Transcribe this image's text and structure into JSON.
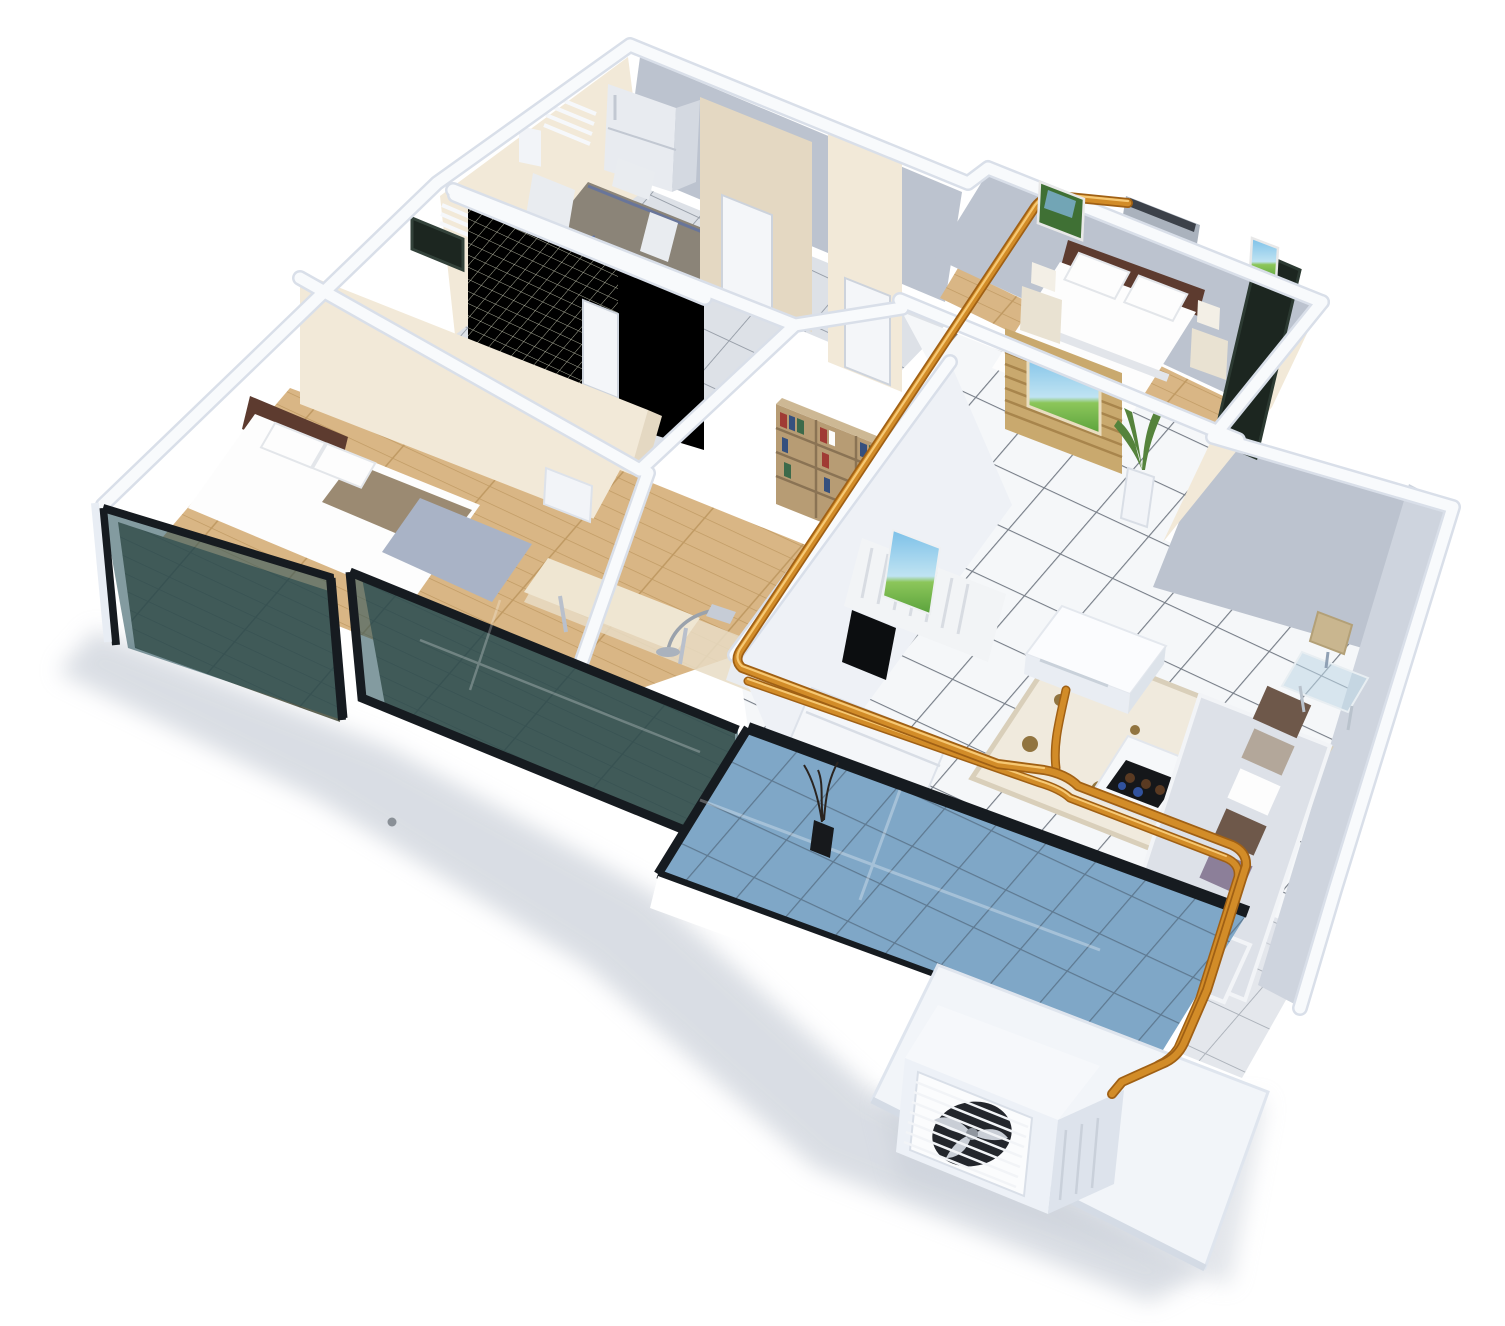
{
  "scene": {
    "description": "3D isometric cutaway rendering of a three-room apartment illustrating a multi-split air-conditioning installation: orange copper refrigerant pipes run from an outdoor condenser unit on a ground pad, up through the glass-fronted balcony, across the living-room floor and along interior wall tops to a ceiling cassette unit in the living room and a wall-mounted AC unit in the master bedroom.",
    "background": "plain white with soft drop shadow under the model",
    "rooms": [
      {
        "name": "kitchen-dining",
        "features": [
          "refrigerator",
          "dining table with blue frame",
          "white chairs",
          "louvered wall vents",
          "gray tile floor"
        ]
      },
      {
        "name": "bathroom",
        "features": [
          "green-gray mosaic tiled walls",
          "dark framed windows",
          "white door"
        ]
      },
      {
        "name": "storage-room",
        "features": [
          "white doors",
          "cream walls"
        ]
      },
      {
        "name": "hallway",
        "features": [
          "white floor tiles with dark grout"
        ]
      },
      {
        "name": "master-bedroom",
        "features": [
          "wall-mounted AC unit",
          "double bed with dark headboard",
          "two nightstands with lamps",
          "wall pictures",
          "wooden slat screen with nature print",
          "potted plant",
          "dark window",
          "wood floor"
        ]
      },
      {
        "name": "bedroom-2",
        "features": [
          "double bed with taupe runner and blue blanket",
          "white side cabinet",
          "wood floor",
          "glass-fronted balcony"
        ]
      },
      {
        "name": "study",
        "features": [
          "bookshelf with books",
          "desk with arc lamp",
          "white chair",
          "wood floor",
          "glass-fronted balcony"
        ]
      },
      {
        "name": "living-room",
        "features": [
          "L-shaped sofa with pillows",
          "floral rug",
          "white coffee table with snack tray",
          "side table with lamp",
          "TV wall with landscape print and flat TV",
          "TV console",
          "ceiling cassette AC unit",
          "white tile floor"
        ]
      },
      {
        "name": "balcony",
        "features": [
          "blue glass tile floor",
          "tinted glass balustrade",
          "vase with dry branches"
        ]
      },
      {
        "name": "outdoor-pad",
        "features": [
          "white concrete slab",
          "condenser unit with round fan"
        ]
      }
    ],
    "hvac": {
      "indoor_units": [
        {
          "type": "wall-mounted-split",
          "location": "master-bedroom"
        },
        {
          "type": "ceiling-cassette",
          "location": "living-room"
        }
      ],
      "outdoor_unit": {
        "type": "condenser-with-fan",
        "location": "ground pad below balcony"
      },
      "piping": {
        "material": "copper",
        "color": "orange",
        "route": "outdoor unit → up through balcony → double run across living-room floor → branch to ceiling cassette → along wall tops diagonally → wall unit in master bedroom"
      }
    }
  },
  "colors": {
    "bg": "#ffffff",
    "shadow": "#c6ccd6",
    "wallCap": "#f8fafc",
    "wallCapEdge": "#d9dfe9",
    "wallCream": "#f2e9d8",
    "wallCreamShade": "#e4d8c2",
    "wallGray": "#bcc3cf",
    "wallGrayLight": "#ced4de",
    "wallWhite": "#eef1f6",
    "tileWhite": "#f5f7f9",
    "tileGrout": "#767d87",
    "tileGray": "#dde1e7",
    "tileGrayGrout": "#99a0aa",
    "tileBlue": "#85aec9",
    "tileBlueGrout": "#3c4752",
    "woodLight": "#d9b685",
    "woodMid": "#c09a63",
    "woodDark": "#5f6454",
    "woodDarkPlank": "#4d5246",
    "glassTeal": "rgba(42,82,92,0.58)",
    "glassBlue": "rgba(122,162,196,0.55)",
    "frameDark": "#161b20",
    "pipeDark": "#a06014",
    "pipe": "#d28c28",
    "pipeLight": "#f6c873",
    "acSilver": "#aab2bd",
    "acVent": "#3c4149",
    "fanDark": "#23262c",
    "unitWhite": "#edf1f7",
    "bedHeadboard": "#5d3b2f",
    "linenWhite": "#fdfdfd",
    "runner": "#9b8a72",
    "blanket": "#a9b3c6",
    "sofa": "#dde1e8",
    "pillowBrown": "#6e584a",
    "pillowPurple": "#8c7f99",
    "pillowTaupe": "#b3a79a",
    "rugBase": "#f0eadd",
    "rugRose": "#87682f",
    "bookWood": "#b79c74",
    "bookRed": "#a03b34",
    "bookBlue": "#35507e",
    "bookGreen": "#3c6a4a",
    "screenWood": "#c9a96e",
    "screenSlat": "#a8854c",
    "plantGreen": "#55833c",
    "skyBlue": "#7cc0e8",
    "grassGreen": "#5aa23c",
    "tableTop": "#8b8478",
    "chairWhite": "#e9ecf0",
    "windowDark": "#1c2620"
  }
}
